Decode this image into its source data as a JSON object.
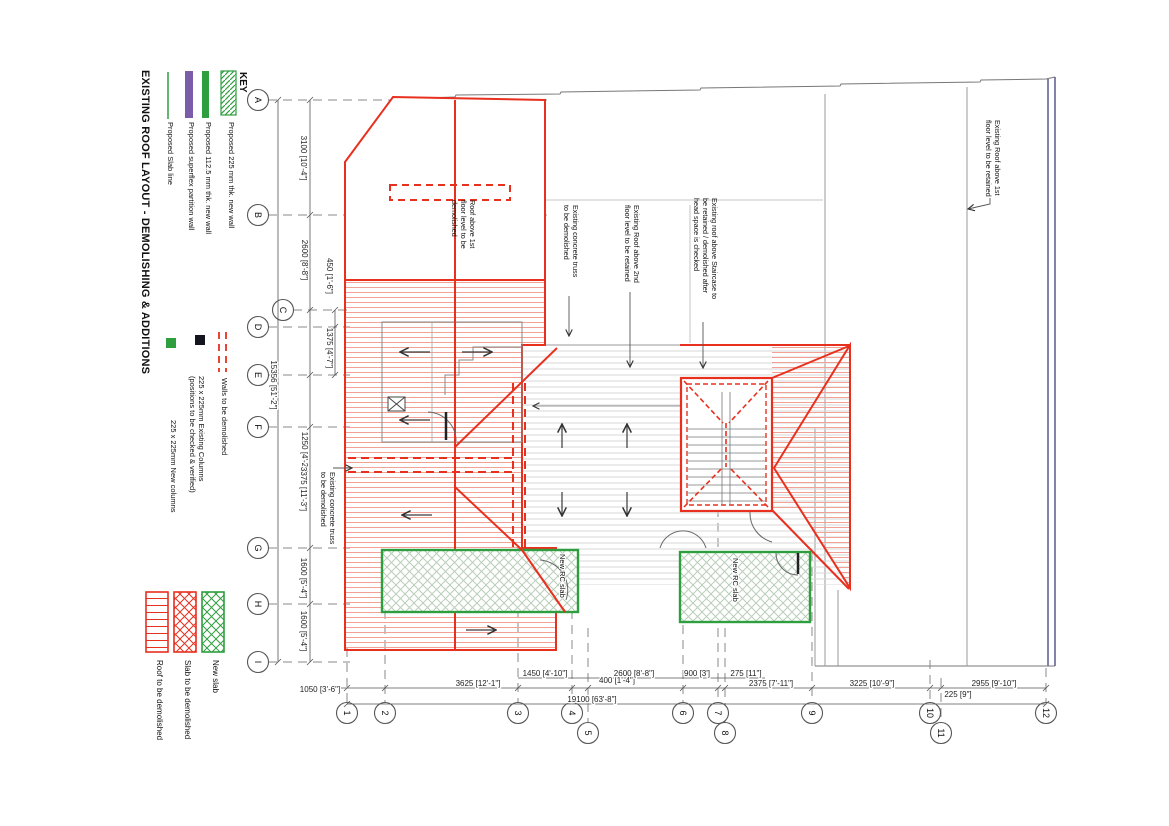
{
  "title": "EXISTING ROOF LAYOUT - DEMOLISHING & ADDITIONS",
  "key": {
    "heading": "KEY",
    "wall_items": [
      {
        "label": "Proposed 225 mm thk. new wall",
        "swatch": "green-diagonal-hatch"
      },
      {
        "label": "Proposed 112.5 mm thk. new wall",
        "swatch": "green-solid-bar"
      },
      {
        "label": "Proposed superflex partition wall",
        "swatch": "purple-solid-bar"
      },
      {
        "label": "Proposed Slab line",
        "swatch": "green-thin-line"
      }
    ],
    "symbol_items": [
      {
        "label": "Walls to be demolished",
        "swatch": "red-dashed-lines"
      },
      {
        "label_line1": "225 x 225mm Existing Columns",
        "label_line2": "(positions to be checked & verified)",
        "swatch": "black-square"
      },
      {
        "label": "225 x 225mm New columns",
        "swatch": "green-square"
      }
    ],
    "area_items": [
      {
        "label": "Roof to be demolished",
        "swatch": "red-horizontal-hatch-box"
      },
      {
        "label": "Slab to be demolished",
        "swatch": "red-cross-hatch-box"
      },
      {
        "label": "New slab",
        "swatch": "green-cross-hatch-box"
      }
    ]
  },
  "grid": {
    "rows": [
      "A",
      "B",
      "C",
      "D",
      "E",
      "F",
      "G",
      "H",
      "I"
    ],
    "cols": [
      "1",
      "2",
      "3",
      "4",
      "5",
      "6",
      "7",
      "8",
      "9",
      "10",
      "11",
      "12"
    ]
  },
  "dimensions": {
    "left": [
      "3100 [10'-4\"]",
      "2600 [8'-8\"]",
      "450 [1'-6\"]",
      "1375 [4'-7\"]",
      "15356 [51'-2\"]",
      "1250 [4'-2\"]",
      "3375 [11'-3\"]",
      "1600 [5'-4\"]",
      "1600 [5'-4\"]"
    ],
    "bottom": [
      "1050 [3'-6\"]",
      "3625 [12'-1\"]",
      "1450 [4'-10\"]",
      "400 [1'-4\"]",
      "19100 [63'-8\"]",
      "2600 [8'-8\"]",
      "900 [3']",
      "275 [11\"]",
      "2375 [7'-11\"]",
      "3225 [10'-9\"]",
      "225 [9\"]",
      "2955 [9'-10\"]"
    ]
  },
  "annotations": {
    "roof_1st_demolish": {
      "l1": "Roof above 1st",
      "l2": "floor level to be",
      "l3": "demolished"
    },
    "truss_top": {
      "l1": "Existing concrete truss",
      "l2": "to be  demolished"
    },
    "roof_2nd_retained": {
      "l1": "Existing Roof above 2nd",
      "l2": "floor level to be retained"
    },
    "stair_roof": {
      "l1": "Existing roof above Staircase to",
      "l2": "be retained / demolished after",
      "l3": "head space is checked"
    },
    "roof_1st_retained": {
      "l1": "Existing Roof above 1st",
      "l2": "floor level to be retained"
    },
    "truss_left": {
      "l1": "Existing concrete truss",
      "l2": "to be  demolished"
    },
    "new_rc_slab_left": "New RC slab",
    "new_rc_slab_right": "New RC slab"
  },
  "colors": {
    "demolish_red": "#e8301f",
    "roof_hatch_salmon": "#f2a195",
    "new_green": "#2f9e3f",
    "pale_green_hatch": "#b9cdb9",
    "partition_purple": "#7b5ca8",
    "retained_navy": "#62629a",
    "building_gray": "#8a8a8a"
  }
}
